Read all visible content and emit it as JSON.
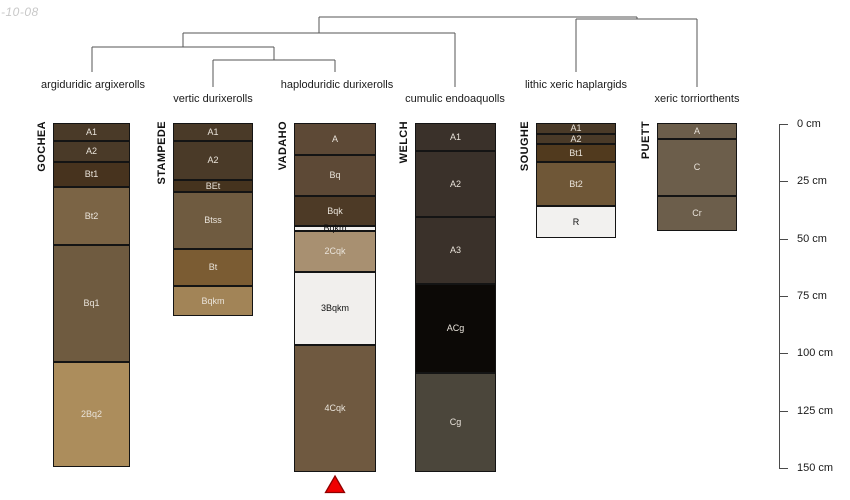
{
  "watermark": {
    "text": "-10-08"
  },
  "colors": {
    "background": "#ffffff",
    "dendrogram_line": "#555555",
    "horizon_border": "#141414",
    "axis": "#4a4a4a",
    "text": "#1a1a1a",
    "horizon_text_light": "#e9e3da",
    "horizon_text_dark": "#111111",
    "marker_fill": "#f10000",
    "marker_stroke": "#8f0000",
    "watermark_text": "#c8c8c8"
  },
  "chart_data": {
    "type": "soil-profile-dendrogram",
    "title": "",
    "depth_axis": {
      "unit": "cm",
      "range_cm": [
        0,
        150
      ],
      "x_px": 779,
      "y0_px": 124,
      "px_per_cm": 2.2933,
      "tick_len_px": 9,
      "label_offset_px": 18,
      "ticks": [
        {
          "cm": 0,
          "label": "0 cm"
        },
        {
          "cm": 25,
          "label": "25 cm"
        },
        {
          "cm": 50,
          "label": "50 cm"
        },
        {
          "cm": 75,
          "label": "75 cm"
        },
        {
          "cm": 100,
          "label": "100 cm"
        },
        {
          "cm": 125,
          "label": "125 cm"
        },
        {
          "cm": 150,
          "label": "150 cm"
        }
      ]
    },
    "dendrogram": {
      "segments": [
        [
          319,
          17,
          637,
          17
        ],
        [
          319,
          17,
          319,
          33
        ],
        [
          637,
          17,
          637,
          19
        ],
        [
          576,
          19,
          697,
          19
        ],
        [
          576,
          19,
          576,
          72
        ],
        [
          697,
          19,
          697,
          87
        ],
        [
          183,
          33,
          455,
          33
        ],
        [
          183,
          33,
          183,
          47
        ],
        [
          455,
          33,
          455,
          87
        ],
        [
          92,
          47,
          274,
          47
        ],
        [
          92,
          47,
          92,
          72
        ],
        [
          274,
          47,
          274,
          60
        ],
        [
          213,
          60,
          335,
          60
        ],
        [
          213,
          60,
          213,
          87
        ],
        [
          335,
          60,
          335,
          72
        ]
      ]
    },
    "taxa": [
      {
        "text": "argiduridic argixerolls",
        "x": 93,
        "row": 1
      },
      {
        "text": "vertic durixerolls",
        "x": 213,
        "row": 2
      },
      {
        "text": "haploduridic durixerolls",
        "x": 337,
        "row": 1
      },
      {
        "text": "cumulic endoaquolls",
        "x": 455,
        "row": 2
      },
      {
        "text": "lithic xeric haplargids",
        "x": 576,
        "row": 1
      },
      {
        "text": "xeric torriorthents",
        "x": 697,
        "row": 2
      }
    ],
    "profiles": [
      {
        "name": "GOCHEA",
        "taxon": "argiduridic argixerolls",
        "x_px": 53,
        "width_px": 77,
        "horizons": [
          {
            "label": "A1",
            "top_cm": 0,
            "bottom_cm": 8,
            "color": "#4a3a28"
          },
          {
            "label": "A2",
            "top_cm": 8,
            "bottom_cm": 17,
            "color": "#4a3a28"
          },
          {
            "label": "Bt1",
            "top_cm": 17,
            "bottom_cm": 28,
            "color": "#47331e"
          },
          {
            "label": "Bt2",
            "top_cm": 28,
            "bottom_cm": 53,
            "color": "#7b6445"
          },
          {
            "label": "Bq1",
            "top_cm": 53,
            "bottom_cm": 104,
            "color": "#6f5b40"
          },
          {
            "label": "2Bq2",
            "top_cm": 104,
            "bottom_cm": 150,
            "color": "#ac8d5c"
          }
        ]
      },
      {
        "name": "STAMPEDE",
        "taxon": "vertic durixerolls",
        "x_px": 173,
        "width_px": 80,
        "horizons": [
          {
            "label": "A1",
            "top_cm": 0,
            "bottom_cm": 8,
            "color": "#4a3a28"
          },
          {
            "label": "A2",
            "top_cm": 8,
            "bottom_cm": 25,
            "color": "#4a3a28"
          },
          {
            "label": "BEt",
            "top_cm": 25,
            "bottom_cm": 30,
            "color": "#45331e"
          },
          {
            "label": "Btss",
            "top_cm": 30,
            "bottom_cm": 55,
            "color": "#6f5b40"
          },
          {
            "label": "Bt",
            "top_cm": 55,
            "bottom_cm": 71,
            "color": "#7b5c33"
          },
          {
            "label": "Bqkm",
            "top_cm": 71,
            "bottom_cm": 84,
            "color": "#a28457"
          }
        ]
      },
      {
        "name": "VADAHO",
        "taxon": "haploduridic durixerolls",
        "x_px": 294,
        "width_px": 82,
        "horizons": [
          {
            "label": "A",
            "top_cm": 0,
            "bottom_cm": 14,
            "color": "#5d4936"
          },
          {
            "label": "Bq",
            "top_cm": 14,
            "bottom_cm": 32,
            "color": "#5d4936"
          },
          {
            "label": "Bqk",
            "top_cm": 32,
            "bottom_cm": 45,
            "color": "#4d3a26"
          },
          {
            "label": "Bqkm",
            "top_cm": 45,
            "bottom_cm": 47,
            "color": "#f2f0ee",
            "text": "#111111"
          },
          {
            "label": "2Cqk",
            "top_cm": 47,
            "bottom_cm": 65,
            "color": "#a89071"
          },
          {
            "label": "3Bqkm",
            "top_cm": 65,
            "bottom_cm": 97,
            "color": "#f1efed",
            "text": "#111111"
          },
          {
            "label": "4Cqk",
            "top_cm": 97,
            "bottom_cm": 152,
            "color": "#6f5940"
          }
        ]
      },
      {
        "name": "WELCH",
        "taxon": "cumulic endoaquolls",
        "x_px": 415,
        "width_px": 81,
        "horizons": [
          {
            "label": "A1",
            "top_cm": 0,
            "bottom_cm": 12,
            "color": "#3a312a"
          },
          {
            "label": "A2",
            "top_cm": 12,
            "bottom_cm": 41,
            "color": "#3a312a"
          },
          {
            "label": "A3",
            "top_cm": 41,
            "bottom_cm": 70,
            "color": "#3a312a"
          },
          {
            "label": "ACg",
            "top_cm": 70,
            "bottom_cm": 109,
            "color": "#0c0906"
          },
          {
            "label": "Cg",
            "top_cm": 109,
            "bottom_cm": 152,
            "color": "#4b463b"
          }
        ]
      },
      {
        "name": "SOUGHE",
        "taxon": "lithic xeric haplargids",
        "x_px": 536,
        "width_px": 80,
        "horizons": [
          {
            "label": "A1",
            "top_cm": 0,
            "bottom_cm": 5,
            "color": "#4a3a28"
          },
          {
            "label": "A2",
            "top_cm": 5,
            "bottom_cm": 9,
            "color": "#4a3a28"
          },
          {
            "label": "Bt1",
            "top_cm": 9,
            "bottom_cm": 17,
            "color": "#513a1e"
          },
          {
            "label": "Bt2",
            "top_cm": 17,
            "bottom_cm": 36,
            "color": "#6f5737"
          },
          {
            "label": "R",
            "top_cm": 36,
            "bottom_cm": 50,
            "color": "#f2f1ef",
            "text": "#111111"
          }
        ]
      },
      {
        "name": "PUETT",
        "taxon": "xeric torriorthents",
        "x_px": 657,
        "width_px": 80,
        "horizons": [
          {
            "label": "A",
            "top_cm": 0,
            "bottom_cm": 7,
            "color": "#6c5e4b"
          },
          {
            "label": "C",
            "top_cm": 7,
            "bottom_cm": 32,
            "color": "#6c5e4b"
          },
          {
            "label": "Cr",
            "top_cm": 32,
            "bottom_cm": 47,
            "color": "#6c5e4b"
          }
        ]
      }
    ],
    "marker": {
      "shape": "triangle-up",
      "x_px": 335,
      "tip_y_px": 476,
      "base_y_px": 492.5,
      "half_width_px": 9.5
    }
  }
}
